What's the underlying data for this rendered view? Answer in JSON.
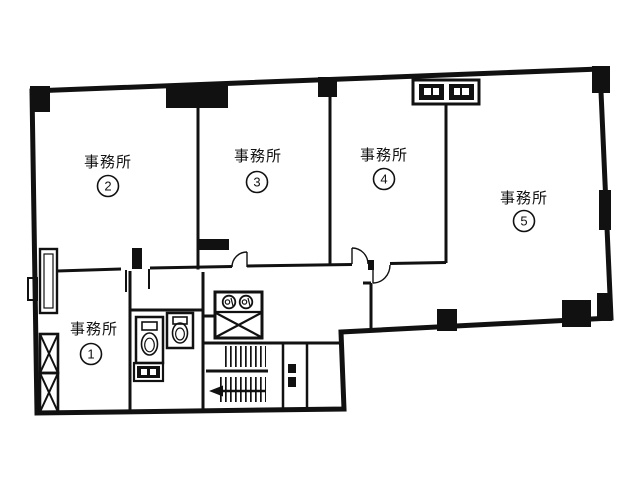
{
  "document": {
    "type": "floor-plan",
    "language": "ja"
  },
  "colors": {
    "line": "#111111",
    "background": "#ffffff"
  },
  "rooms": [
    {
      "label": "事務所",
      "number": "1"
    },
    {
      "label": "事務所",
      "number": "2"
    },
    {
      "label": "事務所",
      "number": "3"
    },
    {
      "label": "事務所",
      "number": "4"
    },
    {
      "label": "事務所",
      "number": "5"
    }
  ],
  "symbols": {
    "toilet_icons": 2,
    "elevator_icon": "box-with-x",
    "washbasin_icons": 2,
    "stair_icon": "u-staircase-hatched-treads",
    "stair_arrow_icon": "left-arrow",
    "shaft_x_icons": 2,
    "duct_shaft_boxes": 2,
    "pipe_space_box": "dark-box-with-light-glyphs"
  }
}
